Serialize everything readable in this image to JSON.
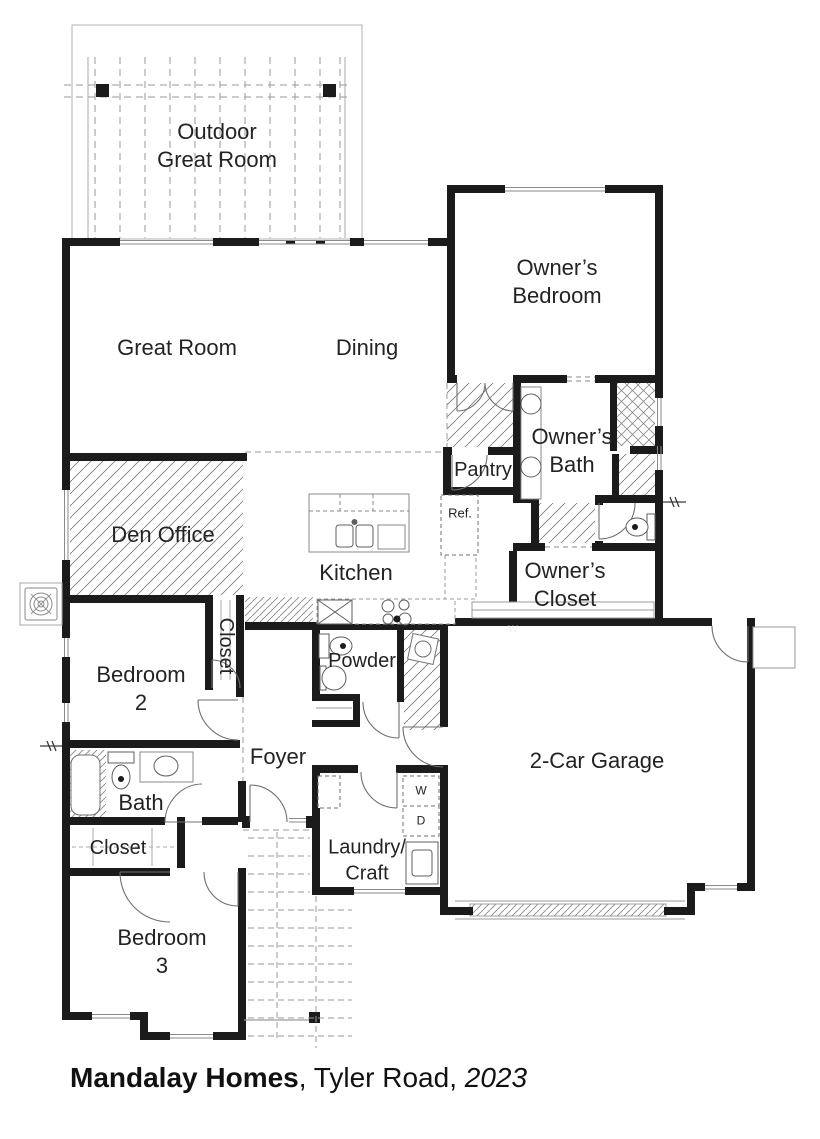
{
  "plan": {
    "rooms": {
      "outdoor_great_room": "Outdoor\nGreat Room",
      "owners_bedroom": "Owner’s\nBedroom",
      "great_room": "Great Room",
      "dining": "Dining",
      "den_office": "Den Office",
      "kitchen": "Kitchen",
      "pantry": "Pantry",
      "owners_bath": "Owner’s\nBath",
      "owners_closet": "Owner’s\nCloset",
      "closet_bedroom2": "Closet",
      "bedroom2": "Bedroom\n2",
      "powder": "Powder",
      "foyer": "Foyer",
      "garage": "2-Car Garage",
      "bath": "Bath",
      "hall_closet": "Closet",
      "laundry": "Laundry/\nCraft",
      "bedroom3": "Bedroom\n3"
    },
    "appliances": {
      "refrigerator": "Ref.",
      "washer": "W",
      "dryer": "D",
      "closet_marker": "W"
    },
    "colors": {
      "wall": "#1b1b1b",
      "thin_line": "#8a8a8a",
      "hatch": "#7d7d7d",
      "text": "#232323"
    }
  },
  "caption": {
    "builder": "Mandalay Homes",
    "middle": ", Tyler Road, ",
    "year": "2023"
  }
}
